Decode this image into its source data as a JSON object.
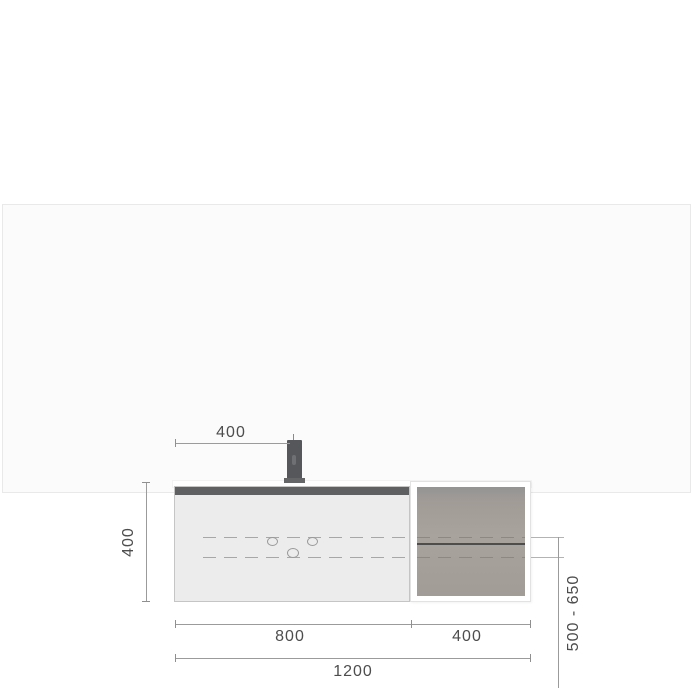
{
  "diagram": {
    "type": "technical-dimension-drawing",
    "subject": "Wall-mounted vanity unit with mixer tap and open side shelf, front elevation",
    "dimensions": {
      "tap_offset": "400",
      "unit_height": "400",
      "vanity_width": "800",
      "side_shelf_width": "400",
      "total_width": "1200",
      "mounting_height_range": "500 - 650"
    },
    "colors": {
      "page_bg": "#ffffff",
      "panel_bg": "#fbfbfb",
      "panel_border": "#e9e9e9",
      "dimension_line": "#9b9b9b",
      "dimension_text": "#4d4d4d",
      "cabinet_body": "#ececec",
      "cabinet_trim": "#5e6062",
      "faucet": "#55575a",
      "shelf_interior": "#a5a09a",
      "shelf_board": "#4d4d4d"
    }
  }
}
